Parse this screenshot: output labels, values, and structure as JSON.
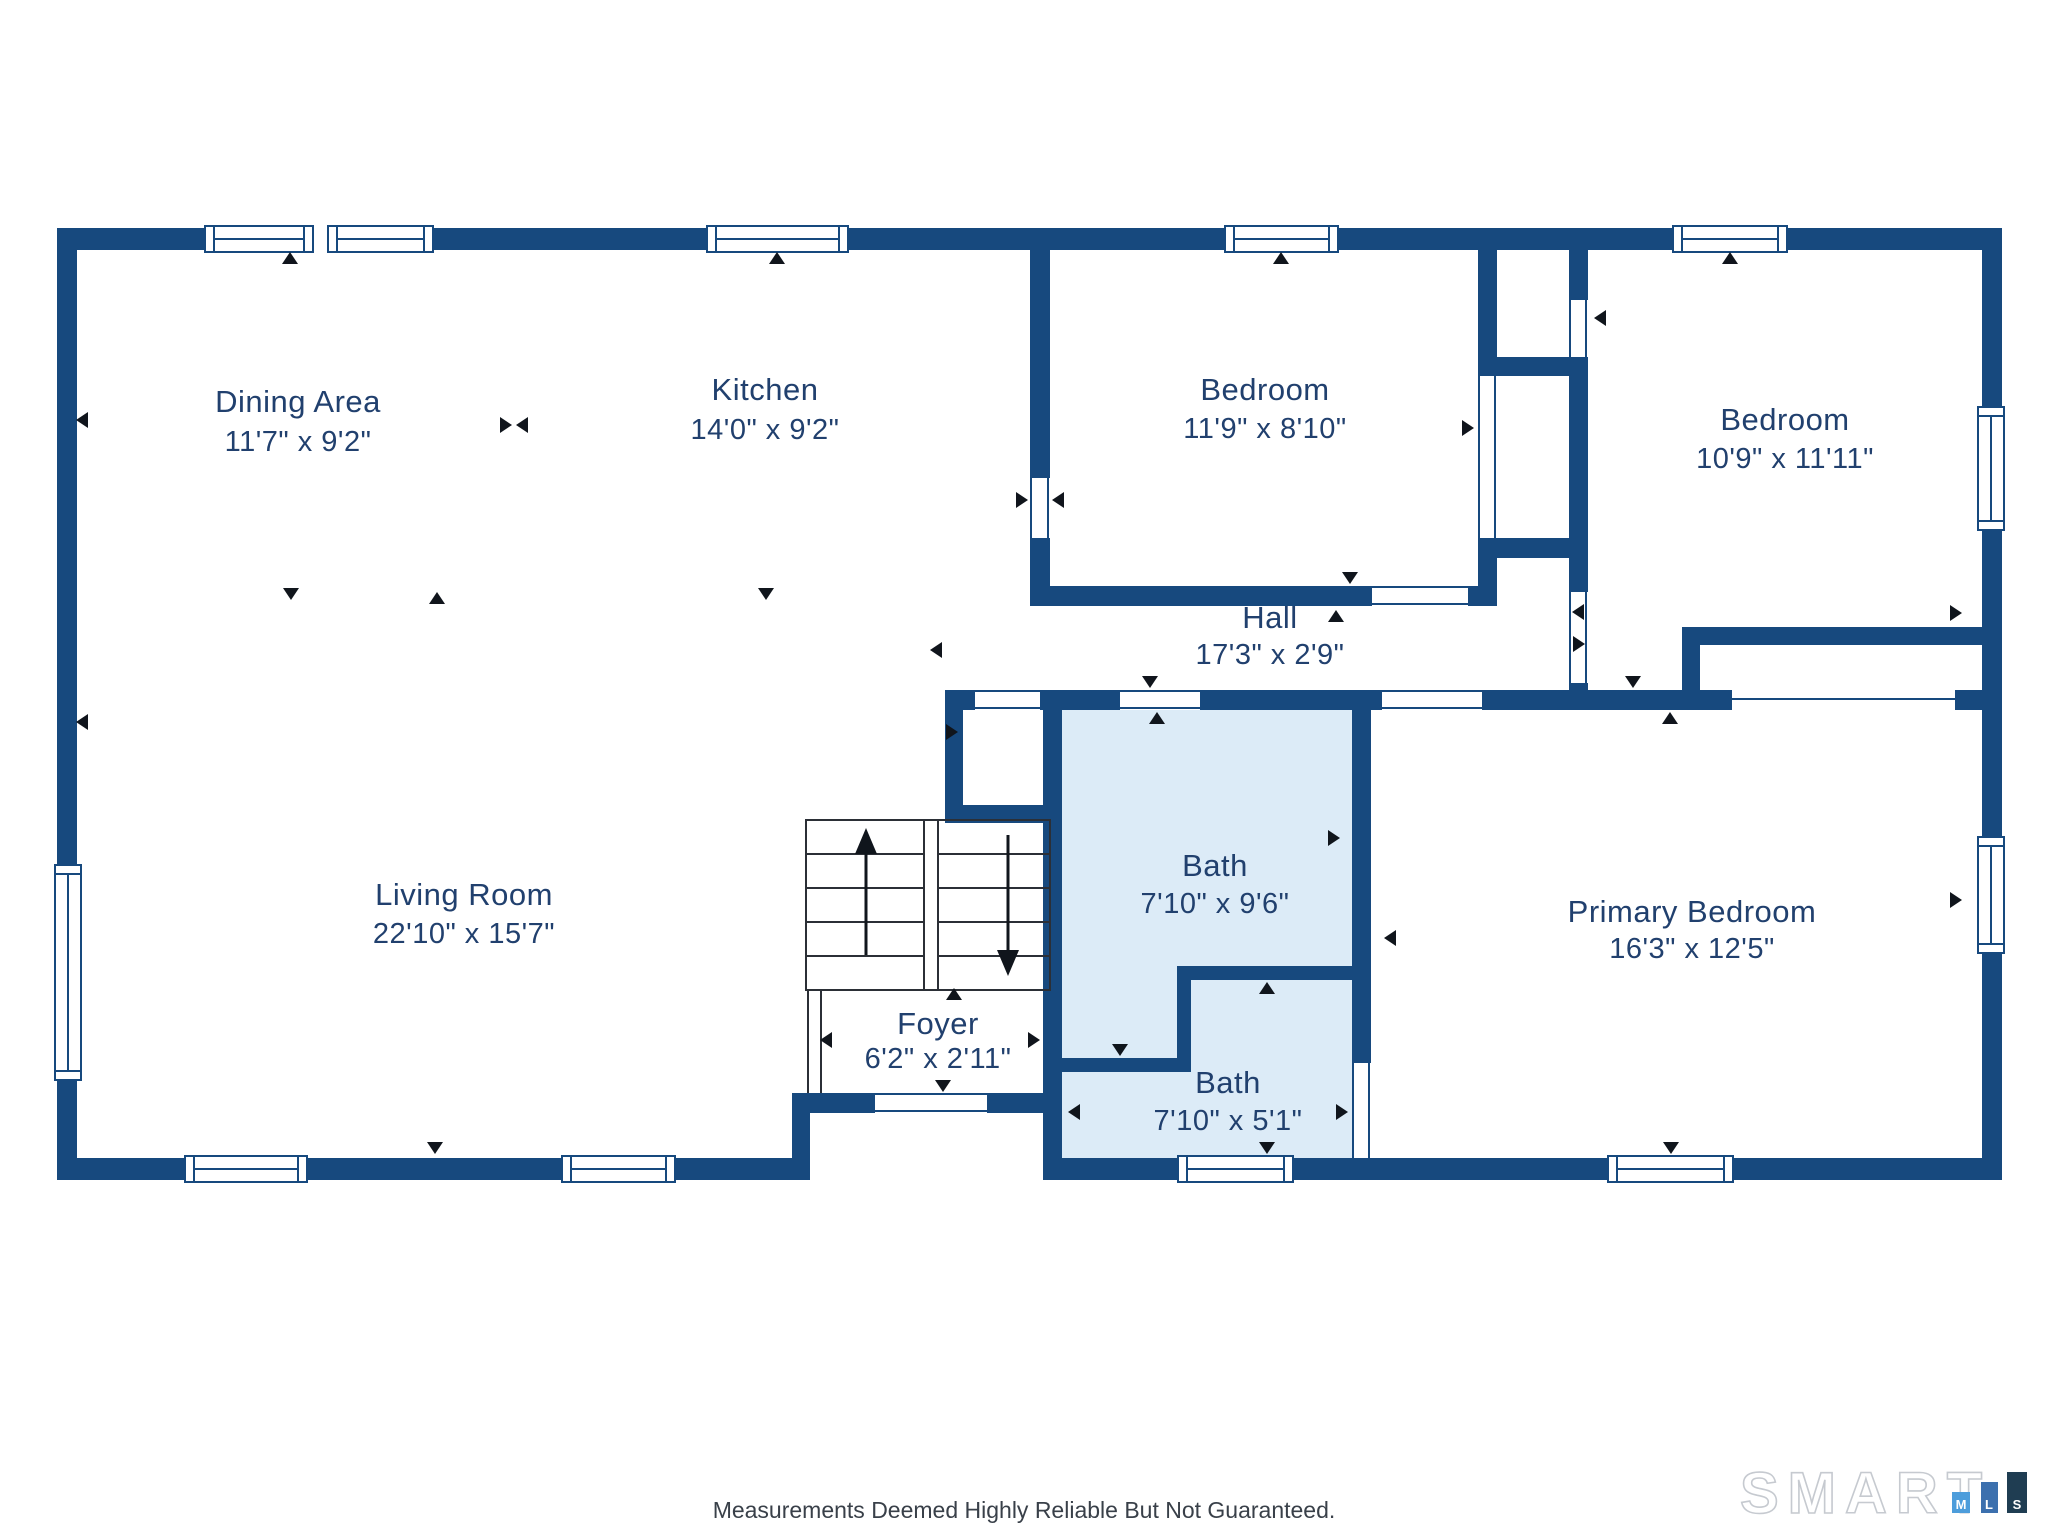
{
  "floorplan": {
    "rooms": [
      {
        "name": "Dining Area",
        "dims": "11'7\" x 9'2\""
      },
      {
        "name": "Kitchen",
        "dims": "14'0\" x 9'2\""
      },
      {
        "name": "Bedroom",
        "dims": "11'9\" x 8'10\""
      },
      {
        "name": "Bedroom",
        "dims": "10'9\" x 11'11\""
      },
      {
        "name": "Hall",
        "dims": "17'3\" x 2'9\""
      },
      {
        "name": "Living Room",
        "dims": "22'10\" x 15'7\""
      },
      {
        "name": "Bath",
        "dims": "7'10\" x 9'6\""
      },
      {
        "name": "Bath",
        "dims": "7'10\" x 5'1\""
      },
      {
        "name": "Foyer",
        "dims": "6'2\" x 2'11\""
      },
      {
        "name": "Primary Bedroom",
        "dims": "16'3\" x 12'5\""
      }
    ],
    "colors": {
      "wall": "#17497E",
      "bath_fill": "#DCEBF7",
      "label_text": "#21406E",
      "marker": "#10151C"
    }
  },
  "footer": {
    "disclaimer": "Measurements Deemed Highly Reliable But Not Guaranteed."
  },
  "logo": {
    "brand": "SMART",
    "blocks": [
      {
        "letter": "M",
        "color": "#4D9DDB"
      },
      {
        "letter": "L",
        "color": "#3C70AE"
      },
      {
        "letter": "S",
        "color": "#1F3D52"
      }
    ]
  }
}
